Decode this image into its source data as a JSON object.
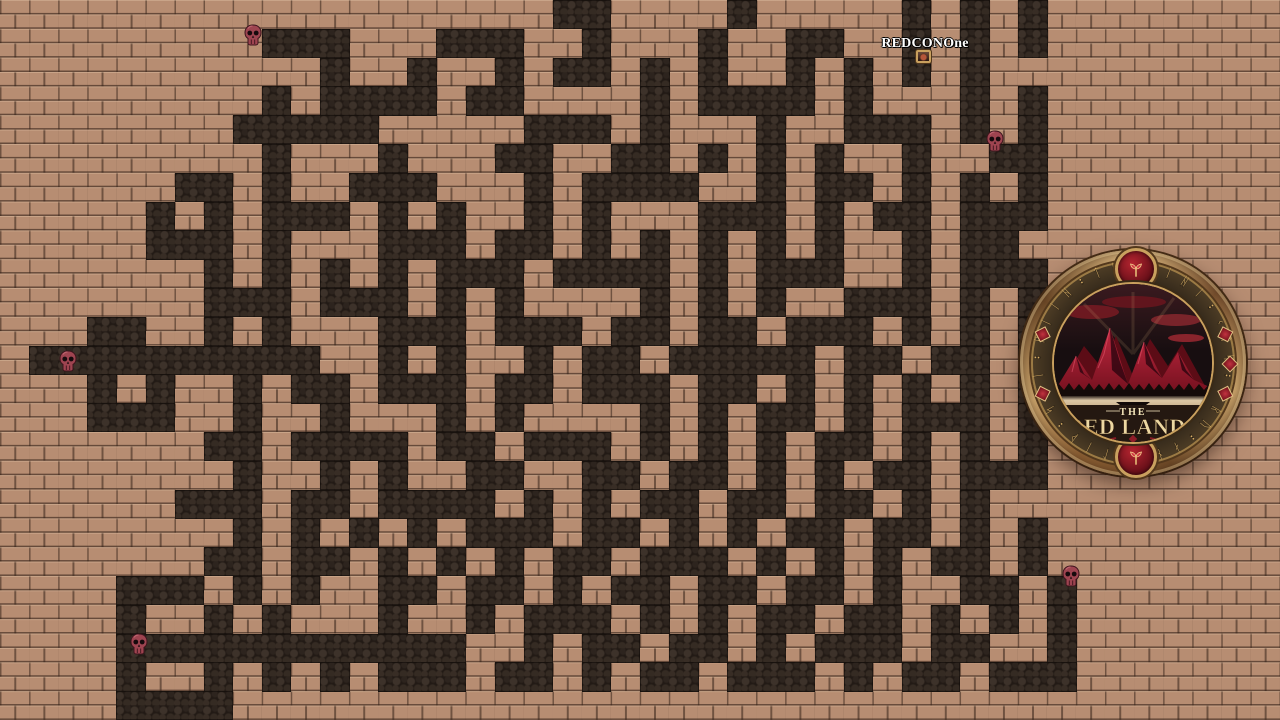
{
  "scene": {
    "width": 1280,
    "height": 720
  },
  "player": {
    "name": "REDCONOne",
    "label_x": 925,
    "label_y": 36,
    "sprite_x": 916,
    "sprite_y": 50
  },
  "maze": {
    "cols": 44,
    "rows": 25,
    "cell_w": 29.0909,
    "cell_h": 28.8,
    "floor_color": "#b78d72",
    "path_color": "#221a15",
    "stone_color": "#3d322a",
    "grid": [
      "...................##....#.....#.#.#........",
      ".........###...###..#...#..##..#.#.#........",
      "...........#..#..#.##.#.#..#.#.#.#..........",
      ".........#.####.##....#.####.#...#.#........",
      "........#####.....###.#...#..###.#.#........",
      ".........#...#...##..##.#.#.#..#..##........",
      "......##.#..###...#.####..#.##.#.#.#........",
      ".....#.#.###.#.#..#.#...###.#.##.###........",
      ".....###.#...###.##.#.#.#.#.#..#.##.........",
      ".......#.#.#.#.###.####.#.###..#.###........",
      ".......###.###.#.#....#.#.#..###.#.#........",
      "...##..#.#...###.###.##.##.###.#.#.#........",
      ".##########..#.#..#.##.#####.##.##.#........",
      "...#.#..#.##.###.##.###.##.#.#.#.#.#........",
      "...###..#..#...#.#....#.#.##.#.###.#........",
      ".......##.####.##.###.#.#.#.##.#.#.#........",
      "........#..#.#..##..##.##.#.#.##.###........",
      "......###.##.####.#.#.##.##.##.#.#..........",
      "........#.#.#.#.###.##.#.#.##.##.#.#........",
      ".......##.##.#.#.#.##.###.#.#.#.##.#........",
      "....###.#.#..##.##.#.##.##.##.#..##.#.......",
      "....#..#.#...#..#.###.#.#.##.##.#.#.#.......",
      "....############..#.##.##.#.###.##..#.......",
      "....#..#.#.#.###.##.#.##.###.#.##.###.......",
      "....####...................................."
    ]
  },
  "skulls": [
    {
      "x": 253,
      "y": 35
    },
    {
      "x": 995,
      "y": 141
    },
    {
      "x": 68,
      "y": 361
    },
    {
      "x": 1071,
      "y": 576
    },
    {
      "x": 139,
      "y": 644
    }
  ],
  "skull_color": "#9e4450",
  "logo": {
    "cx": 1133,
    "cy": 363,
    "radius": 113,
    "title_small": "THE",
    "title_large": "RED LANDS",
    "runes": "ᚺᛁᛁᚺᛁ᛬ᚲᛏᛋ᛬ᛟᚱᚢ᛬ᛅᚾᛒ᛬ᛚᛁᚦ᛬ᛋᛏᛁ᛬ᚺᛁᛁᚺ᛬ᛏᛋ",
    "accent_angles": [
      72,
      90,
      108,
      252,
      288
    ],
    "colors": {
      "ring_gold": "#c9a36b",
      "ring_dark": "#6e4a28",
      "band": "#2e2418",
      "rune_gold": "#d8ae66",
      "gem_red": "#b3242f",
      "mountain_red": "#c22840",
      "mountain_shadow": "#6e0f1c",
      "mist": "#dcc8a6",
      "text_cream": "#ecd7a2",
      "filigree_red": "#8e1c28"
    }
  }
}
